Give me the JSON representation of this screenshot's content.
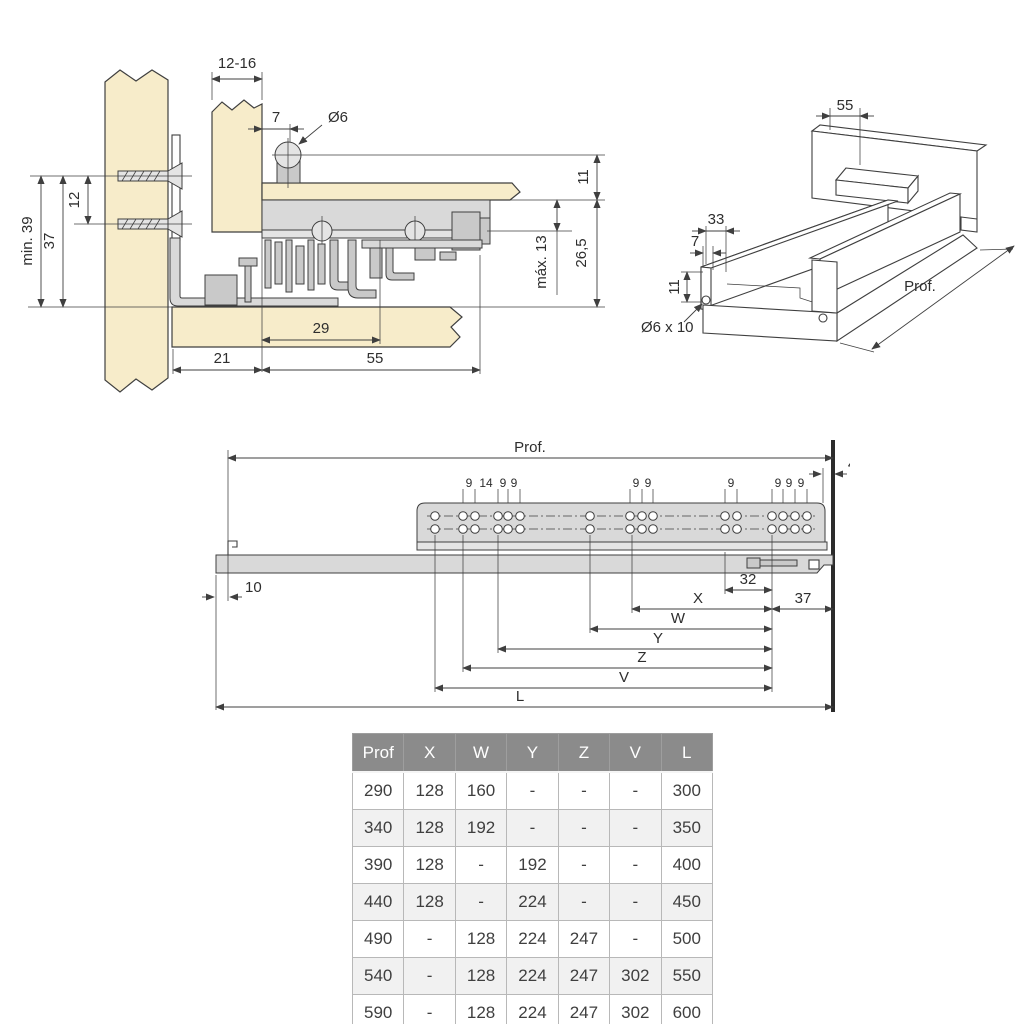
{
  "colors": {
    "wood": "#f7ecca",
    "metal": "#d9d9d9",
    "line": "#3f3f3f",
    "table_header_bg": "#8b8b8b"
  },
  "cross_section": {
    "labels": {
      "panel_thickness": "12-16",
      "offset_7": "7",
      "pin_diameter": "Ø6",
      "clearance_11": "11",
      "screw_spacing_12": "12",
      "min_39": "min. 39",
      "height_37": "37",
      "max_13": "máx. 13",
      "height_26_5": "26,5",
      "depth_29": "29",
      "depth_21": "21",
      "depth_55": "55"
    }
  },
  "isometric": {
    "labels": {
      "back_offset_55": "55",
      "side_33": "33",
      "side_7": "7",
      "front_11": "11",
      "hole": "Ø6 x 10",
      "depth": "Prof."
    }
  },
  "side_view": {
    "labels": {
      "depth": "Prof.",
      "gap_4": "4",
      "pitch_9": "9",
      "pitch_14": "14",
      "dim_10": "10",
      "dim_32": "32",
      "dim_37": "37",
      "x": "X",
      "w": "W",
      "y": "Y",
      "z": "Z",
      "v": "V",
      "l": "L"
    }
  },
  "table": {
    "headers": [
      "Prof",
      "X",
      "W",
      "Y",
      "Z",
      "V",
      "L"
    ],
    "rows": [
      [
        "290",
        "128",
        "160",
        "-",
        "-",
        "-",
        "300"
      ],
      [
        "340",
        "128",
        "192",
        "-",
        "-",
        "-",
        "350"
      ],
      [
        "390",
        "128",
        "-",
        "192",
        "-",
        "-",
        "400"
      ],
      [
        "440",
        "128",
        "-",
        "224",
        "-",
        "-",
        "450"
      ],
      [
        "490",
        "-",
        "128",
        "224",
        "247",
        "-",
        "500"
      ],
      [
        "540",
        "-",
        "128",
        "224",
        "247",
        "302",
        "550"
      ],
      [
        "590",
        "-",
        "128",
        "224",
        "247",
        "302",
        "600"
      ]
    ]
  }
}
